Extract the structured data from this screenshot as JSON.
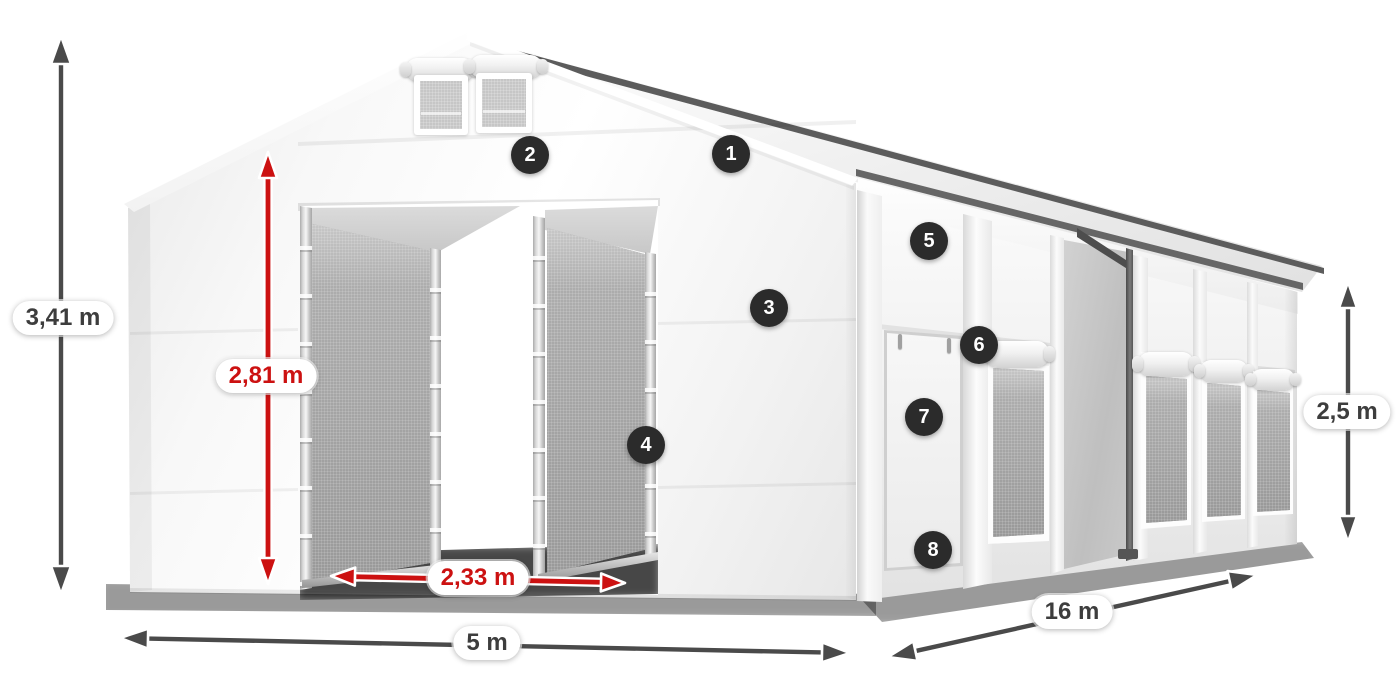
{
  "figure": {
    "kind": "tent-dimensions-diagram",
    "background": "#ffffff"
  },
  "colors": {
    "red_accent": "#cc1111",
    "arrow_dark": "#4a4a4a",
    "badge_background": "#2b2b2b",
    "badge_number": "#ffffff",
    "label_text_dark": "#3d3d3d",
    "label_pill_background": "#ffffff",
    "tent_fabric": "#f6f6f6",
    "mesh_panel": "#a6a6a6"
  },
  "dimensions": [
    {
      "id": "total-height",
      "label": "3,41 m",
      "style": "dark"
    },
    {
      "id": "entrance-height",
      "label": "2,81 m",
      "style": "red"
    },
    {
      "id": "entrance-width",
      "label": "2,33 m",
      "style": "red"
    },
    {
      "id": "front-width",
      "label": "5 m",
      "style": "dark"
    },
    {
      "id": "side-length",
      "label": "16 m",
      "style": "dark"
    },
    {
      "id": "wall-height",
      "label": "2,5 m",
      "style": "dark"
    }
  ],
  "callouts": [
    {
      "number": "1"
    },
    {
      "number": "2"
    },
    {
      "number": "3"
    },
    {
      "number": "4"
    },
    {
      "number": "5"
    },
    {
      "number": "6"
    },
    {
      "number": "7"
    },
    {
      "number": "8"
    }
  ]
}
